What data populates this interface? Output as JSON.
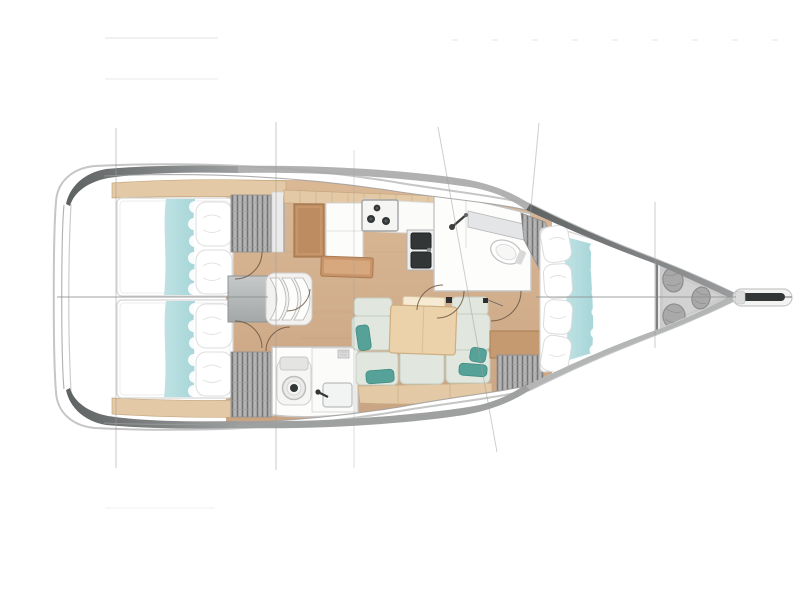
{
  "figure": {
    "type": "yacht-floor-plan",
    "view": "top-down",
    "orientation": "bow-right",
    "description": "Sailing yacht interior layout plan, top view: two aft double cabins, saloon with L-galley and settee with table, two heads, forward V-berth cabin, sail locker with bags, bowsprit with anchor"
  },
  "rooms": [
    "aft-cabin-port",
    "aft-cabin-starboard",
    "companionway",
    "galley",
    "nav-station",
    "saloon",
    "aft-head",
    "forward-head",
    "forward-cabin",
    "sail-locker",
    "bowsprit"
  ],
  "colors": {
    "page_bg": "#ffffff",
    "hull_outline": "#c6c6c6",
    "hull_inner": "#9b9b9b",
    "hull_dark": "#6d7071",
    "hull_mid": "#a9a9a9",
    "floor_wood": "#c9a482",
    "floor_wood_light": "#dab896",
    "trim_wood": "#e3c9a6",
    "trim_wood_edge": "#c6a87f",
    "furniture_wood": "#bd8d61",
    "bench_wood": "#c9946a",
    "table_wood": "#ecd2ab",
    "table_leaf": "#f6ead2",
    "bedding_white": "#ffffff",
    "bedding_teal": "#a7d6d9",
    "pillow_teal": "#56a198",
    "cushion_sage": "#e1e7de",
    "cushion_edge": "#c5ccc1",
    "wardrobe_gray": "#b4b4b4",
    "wardrobe_line": "#747474",
    "fixture_white": "#fdfdfc",
    "fixture_edge": "#c5c5c5",
    "appliance_dark": "#333637",
    "locker_gray": "#cbcbcb",
    "bag_gray": "#a9a9a9",
    "bag_edge": "#8d8d8d",
    "engine_gray": "#b7babb",
    "line_gray": "#9d9d9d",
    "centerline": "#8a8c8d",
    "door_arc": "#6b5642"
  }
}
